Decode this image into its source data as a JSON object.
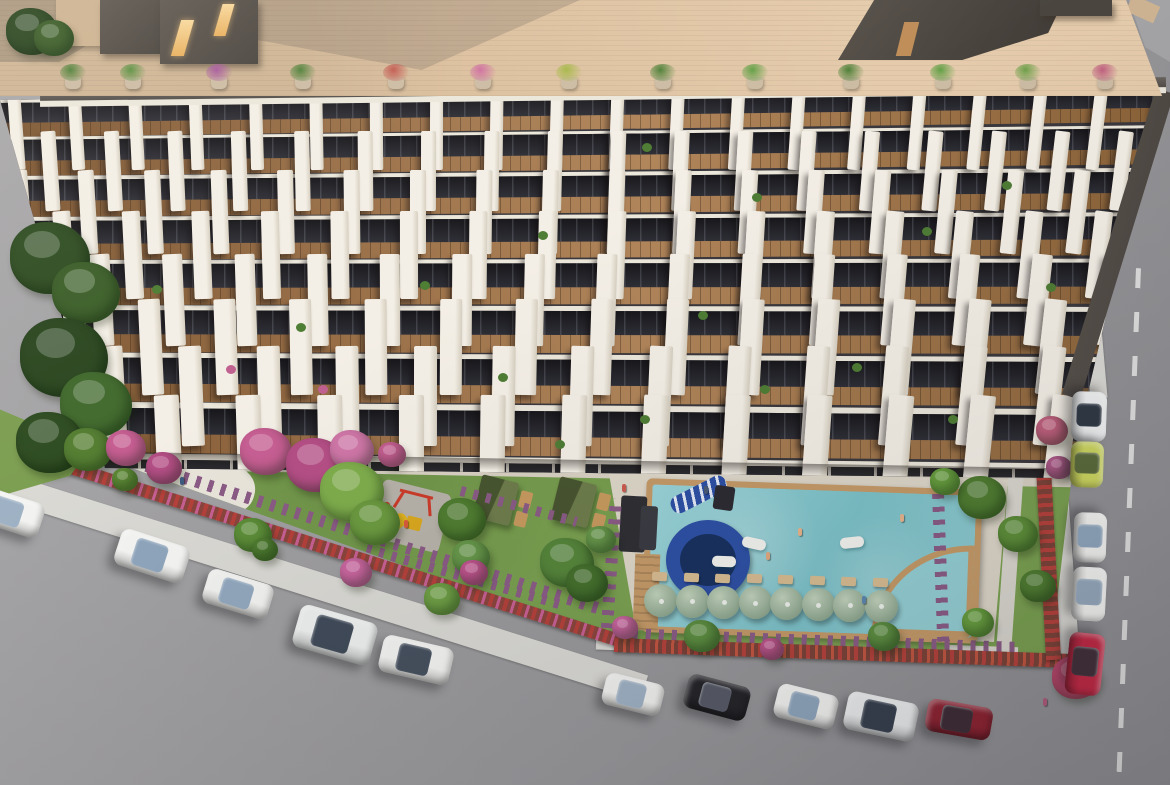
{
  "scene": {
    "label": "aerial-3d-render-residential-complex",
    "width": 1170,
    "height": 785
  },
  "palette": {
    "road": "#9a999b",
    "walk": "#dad9d4",
    "terrace": "#dcc09e",
    "fdark": "#3a383c",
    "slab": "#ece7db",
    "lawn": "#79a04f",
    "pave": "#d8d1c3",
    "deck": "#ded7c9",
    "woodframe": "#c59a67",
    "purple": "#8a5b85",
    "slide": "#2d4fa5",
    "tan": "#c79a5e",
    "pad": "#b7b2a9",
    "red": "#cc3b2a",
    "yellow": "#e3b51f"
  },
  "facade": {
    "rows": [
      {
        "y": 15,
        "h": 37,
        "slab": 3
      },
      {
        "y": 52,
        "h": 39,
        "slab": 3
      },
      {
        "y": 91,
        "h": 41,
        "slab": 4
      },
      {
        "y": 132,
        "h": 43,
        "slab": 4
      },
      {
        "y": 175,
        "h": 45,
        "slab": 4
      },
      {
        "y": 220,
        "h": 47,
        "slab": 5
      },
      {
        "y": 267,
        "h": 49,
        "slab": 5
      },
      {
        "y": 316,
        "h": 51,
        "slab": 6
      },
      {
        "y": 367,
        "h": 26,
        "slab": 6
      }
    ],
    "pillars": {
      "spacing_base": 60,
      "spacing_step": 3,
      "offsets": [
        30,
        0,
        34,
        6,
        40,
        10,
        44,
        14
      ],
      "width_base": 13,
      "width_step": 1.7,
      "height_factor": 2.05,
      "rot_center": 420,
      "rot_span": 12
    },
    "balcony_plants": [
      [
        642,
        58,
        "g"
      ],
      [
        752,
        108,
        "g"
      ],
      [
        922,
        142,
        "g"
      ],
      [
        1046,
        198,
        "g"
      ],
      [
        538,
        146,
        "g"
      ],
      [
        420,
        196,
        "g"
      ],
      [
        296,
        238,
        "g"
      ],
      [
        698,
        226,
        "g"
      ],
      [
        852,
        278,
        "g"
      ],
      [
        498,
        288,
        "g"
      ],
      [
        948,
        330,
        "g"
      ],
      [
        640,
        330,
        "g"
      ],
      [
        152,
        200,
        "g"
      ],
      [
        226,
        280,
        "p"
      ],
      [
        1002,
        96,
        "g"
      ],
      [
        318,
        300,
        "p"
      ],
      [
        760,
        300,
        "g"
      ],
      [
        555,
        355,
        "g"
      ]
    ],
    "plant_colors": {
      "g": "#4e7d34",
      "p": "#c06090"
    }
  },
  "roof": {
    "pots": [
      {
        "x": 60,
        "c": "#4e8038"
      },
      {
        "x": 120,
        "c": "#5a9040"
      },
      {
        "x": 206,
        "c": "#a85a9e"
      },
      {
        "x": 290,
        "c": "#4e8038"
      },
      {
        "x": 383,
        "c": "#c25a50"
      },
      {
        "x": 470,
        "c": "#cf6f9f"
      },
      {
        "x": 556,
        "c": "#a8b84a"
      },
      {
        "x": 650,
        "c": "#4e8038"
      },
      {
        "x": 742,
        "c": "#63a046"
      },
      {
        "x": 838,
        "c": "#4e8038"
      },
      {
        "x": 930,
        "c": "#63a046"
      },
      {
        "x": 1015,
        "c": "#6fa04a"
      },
      {
        "x": 1092,
        "c": "#c06080"
      }
    ],
    "pot_y": 64
  },
  "umbrellas": {
    "count": 8,
    "x0": 644,
    "y0": 584,
    "dx": 31.5,
    "dy": 0.8,
    "d": 33
  },
  "loungers": {
    "count": 8,
    "x0": 652,
    "y0": 572,
    "dx": 31.5,
    "dy": 0.8
  },
  "floats": [
    {
      "x": 742,
      "y": 538,
      "rot": 12
    },
    {
      "x": 840,
      "y": 537,
      "rot": -6
    },
    {
      "x": 712,
      "y": 556,
      "rot": 2
    }
  ],
  "people": [
    {
      "x": 622,
      "y": 484,
      "c": "#cf5a4e"
    },
    {
      "x": 704,
      "y": 486,
      "c": "#4a5a74"
    },
    {
      "x": 798,
      "y": 528,
      "c": "#e8b48c"
    },
    {
      "x": 766,
      "y": 552,
      "c": "#e2a87e"
    },
    {
      "x": 900,
      "y": 514,
      "c": "#e8b48c"
    },
    {
      "x": 862,
      "y": 596,
      "c": "#5a86b0"
    },
    {
      "x": 404,
      "y": 520,
      "c": "#d85a3a"
    },
    {
      "x": 180,
      "y": 477,
      "c": "#3f5a80"
    },
    {
      "x": 1043,
      "y": 698,
      "c": "#b05a7a"
    }
  ],
  "cars": [
    {
      "x": 8,
      "y": 512,
      "l": 70,
      "w": 36,
      "rot": 18,
      "body": "#f3f3f1",
      "glass": "#9fb2c5"
    },
    {
      "x": 152,
      "y": 556,
      "l": 72,
      "w": 38,
      "rot": 18,
      "body": "#f5f5f3",
      "glass": "#8fa6bd"
    },
    {
      "x": 238,
      "y": 594,
      "l": 68,
      "w": 36,
      "rot": 17,
      "body": "#f2f2f0",
      "glass": "#92a8be"
    },
    {
      "x": 335,
      "y": 635,
      "l": 80,
      "w": 44,
      "rot": 16,
      "body": "#eef0ef",
      "glass": "#3f4a58"
    },
    {
      "x": 416,
      "y": 660,
      "l": 72,
      "w": 38,
      "rot": 13,
      "body": "#f4f4f2",
      "glass": "#45505e"
    },
    {
      "x": 633,
      "y": 694,
      "l": 60,
      "w": 33,
      "rot": 14,
      "body": "#f2f2f0",
      "glass": "#9fb2c5"
    },
    {
      "x": 717,
      "y": 697,
      "l": 64,
      "w": 35,
      "rot": 15,
      "body": "#232327",
      "glass": "#565a66"
    },
    {
      "x": 806,
      "y": 706,
      "l": 62,
      "w": 35,
      "rot": 14,
      "body": "#f4f4f2",
      "glass": "#8fa6bd"
    },
    {
      "x": 881,
      "y": 716,
      "l": 72,
      "w": 39,
      "rot": 12,
      "body": "#eceeee",
      "glass": "#353e4c"
    },
    {
      "x": 959,
      "y": 719,
      "l": 66,
      "w": 33,
      "rot": 10,
      "body": "#8e2130",
      "glass": "#3c2a33"
    },
    {
      "x": 1089,
      "y": 416,
      "l": 50,
      "w": 35,
      "rot": 92,
      "body": "#eff1f1",
      "glass": "#2f3844"
    },
    {
      "x": 1087,
      "y": 464,
      "l": 46,
      "w": 33,
      "rot": 92,
      "body": "#ccd65e",
      "glass": "#5a6a3a"
    },
    {
      "x": 1090,
      "y": 537,
      "l": 50,
      "w": 33,
      "rot": 92,
      "body": "#f2f2f0",
      "glass": "#8fa6bd"
    },
    {
      "x": 1089,
      "y": 594,
      "l": 54,
      "w": 34,
      "rot": 93,
      "body": "#f4f4f2",
      "glass": "#95a9bd"
    },
    {
      "x": 1085,
      "y": 664,
      "l": 62,
      "w": 36,
      "rot": 96,
      "body": "#c22743",
      "glass": "#402e38"
    }
  ],
  "cabanas": [
    {
      "x": 474,
      "y": 480
    },
    {
      "x": 552,
      "y": 482
    }
  ],
  "purple_strips": [
    {
      "x": 148,
      "y": 460,
      "w": 480,
      "h": 12,
      "rot": 17.5,
      "v": false
    },
    {
      "x": 620,
      "y": 628,
      "w": 400,
      "h": 12,
      "rot": 2,
      "v": false
    },
    {
      "x": 932,
      "y": 492,
      "w": 12,
      "h": 150,
      "rot": -2,
      "v": true
    },
    {
      "x": 610,
      "y": 498,
      "w": 12,
      "h": 130,
      "rot": 4,
      "v": true
    },
    {
      "x": 368,
      "y": 544,
      "w": 200,
      "h": 10,
      "rot": 16,
      "v": false
    },
    {
      "x": 462,
      "y": 486,
      "w": 120,
      "h": 10,
      "rot": 15,
      "v": false
    }
  ],
  "foliage": [
    {
      "x": 10,
      "y": 222,
      "r": 40,
      "c": "#2f4d22"
    },
    {
      "x": 52,
      "y": 262,
      "r": 34,
      "c": "#3c5f29"
    },
    {
      "x": 20,
      "y": 318,
      "r": 44,
      "c": "#2b4720"
    },
    {
      "x": 60,
      "y": 372,
      "r": 36,
      "c": "#426a2e"
    },
    {
      "x": 16,
      "y": 412,
      "r": 34,
      "c": "#2f4d22"
    },
    {
      "x": 64,
      "y": 428,
      "r": 24,
      "c": "#567f33"
    },
    {
      "x": 6,
      "y": 8,
      "r": 26,
      "c": "#2b4720"
    },
    {
      "x": 34,
      "y": 20,
      "r": 20,
      "c": "#3c5f29"
    },
    {
      "x": 240,
      "y": 428,
      "r": 26,
      "c": "#c75f93"
    },
    {
      "x": 286,
      "y": 438,
      "r": 30,
      "c": "#b54f86"
    },
    {
      "x": 330,
      "y": 430,
      "r": 22,
      "c": "#d077a8"
    },
    {
      "x": 106,
      "y": 430,
      "r": 20,
      "c": "#c75f93"
    },
    {
      "x": 146,
      "y": 452,
      "r": 18,
      "c": "#b54f86"
    },
    {
      "x": 378,
      "y": 442,
      "r": 14,
      "c": "#c75f93"
    },
    {
      "x": 320,
      "y": 462,
      "r": 32,
      "c": "#7fae4c"
    },
    {
      "x": 350,
      "y": 500,
      "r": 25,
      "c": "#6b9a3f"
    },
    {
      "x": 438,
      "y": 498,
      "r": 24,
      "c": "#4f7d30"
    },
    {
      "x": 452,
      "y": 540,
      "r": 19,
      "c": "#67984a"
    },
    {
      "x": 234,
      "y": 518,
      "r": 19,
      "c": "#5d8f38"
    },
    {
      "x": 252,
      "y": 538,
      "r": 13,
      "c": "#4f7d30"
    },
    {
      "x": 424,
      "y": 583,
      "r": 18,
      "c": "#6fa045"
    },
    {
      "x": 460,
      "y": 560,
      "r": 14,
      "c": "#c2558f"
    },
    {
      "x": 340,
      "y": 558,
      "r": 16,
      "c": "#cb66a0"
    },
    {
      "x": 540,
      "y": 538,
      "r": 27,
      "c": "#55863a"
    },
    {
      "x": 566,
      "y": 564,
      "r": 21,
      "c": "#44702c"
    },
    {
      "x": 586,
      "y": 526,
      "r": 15,
      "c": "#67984a"
    },
    {
      "x": 684,
      "y": 620,
      "r": 18,
      "c": "#5d9040"
    },
    {
      "x": 868,
      "y": 622,
      "r": 16,
      "c": "#5d9040"
    },
    {
      "x": 958,
      "y": 476,
      "r": 24,
      "c": "#4f7d30"
    },
    {
      "x": 998,
      "y": 516,
      "r": 20,
      "c": "#5d8f38"
    },
    {
      "x": 1020,
      "y": 570,
      "r": 18,
      "c": "#4f7d30"
    },
    {
      "x": 962,
      "y": 608,
      "r": 16,
      "c": "#68a03e"
    },
    {
      "x": 930,
      "y": 468,
      "r": 15,
      "c": "#68a03e"
    },
    {
      "x": 760,
      "y": 638,
      "r": 12,
      "c": "#c2558f"
    },
    {
      "x": 612,
      "y": 616,
      "r": 13,
      "c": "#cb66a0"
    },
    {
      "x": 1052,
      "y": 656,
      "r": 24,
      "c": "#c0486e"
    },
    {
      "x": 1036,
      "y": 416,
      "r": 16,
      "c": "#c0607e"
    },
    {
      "x": 1046,
      "y": 456,
      "r": 13,
      "c": "#b05a8a"
    },
    {
      "x": 112,
      "y": 468,
      "r": 13,
      "c": "#5e8a36"
    }
  ]
}
